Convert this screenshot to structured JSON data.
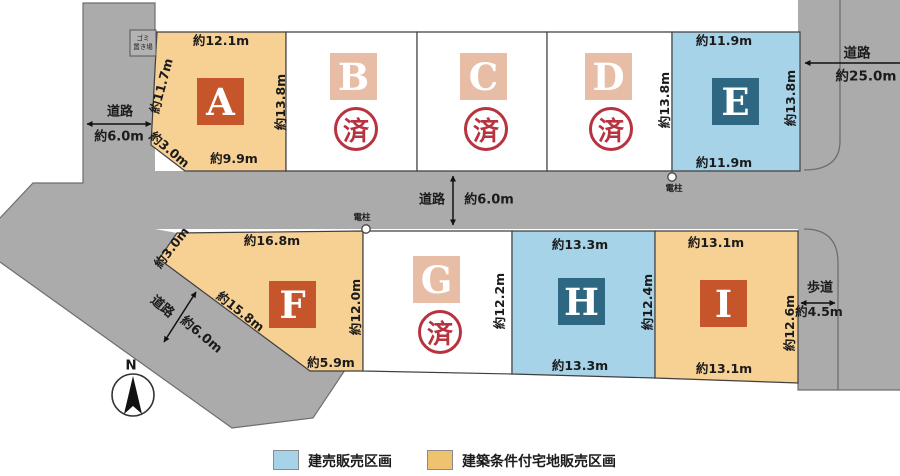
{
  "colors": {
    "road": "#ababab",
    "lot_tan": "#f7d094",
    "lot_blue": "#a7d3e9",
    "lot_sold": "#ffffff",
    "tile_dark_orange": "#c7552b",
    "tile_pale": "#e8bda5",
    "tile_blue": "#2e6781",
    "stamp_red": "#b73340",
    "legend_blue": "#a7d3e9",
    "legend_tan": "#eec26f"
  },
  "lots": {
    "a": {
      "letter": "A",
      "top": "約12.1m",
      "left": "約11.7m",
      "right": "約13.8m",
      "bottom": "約9.9m",
      "corner": "約3.0m"
    },
    "b": {
      "letter": "B",
      "status": "済"
    },
    "c": {
      "letter": "C",
      "status": "済"
    },
    "d": {
      "letter": "D",
      "status": "済",
      "right": "約13.8m"
    },
    "e": {
      "letter": "E",
      "top": "約11.9m",
      "right": "約13.8m",
      "bottom": "約11.9m"
    },
    "f": {
      "letter": "F",
      "top": "約16.8m",
      "corner": "約3.0m",
      "diagonal": "約15.8m",
      "bottom": "約5.9m",
      "right": "約12.0m"
    },
    "g": {
      "letter": "G",
      "status": "済",
      "right": "約12.2m"
    },
    "h": {
      "letter": "H",
      "top": "約13.3m",
      "bottom": "約13.3m",
      "right": "約12.4m"
    },
    "i": {
      "letter": "I",
      "top": "約13.1m",
      "bottom": "約13.1m",
      "right": "約12.6m"
    }
  },
  "roads": {
    "left": {
      "name": "道路",
      "width": "約6.0m"
    },
    "middle": {
      "name": "道路",
      "width": "約6.0m"
    },
    "diagonal": {
      "name": "道路",
      "width": "約6.0m"
    },
    "right": {
      "name": "道路",
      "width": "約25.0m"
    },
    "sidewalk": {
      "name": "歩道",
      "width": "約4.5m"
    }
  },
  "markers": {
    "utility_pole": "電柱",
    "garbage_line1": "ゴミ",
    "garbage_line2": "置き場",
    "compass_north": "N"
  },
  "legend": {
    "built_for_sale": "建売販売区画",
    "conditional_land": "建築条件付宅地販売区画"
  }
}
